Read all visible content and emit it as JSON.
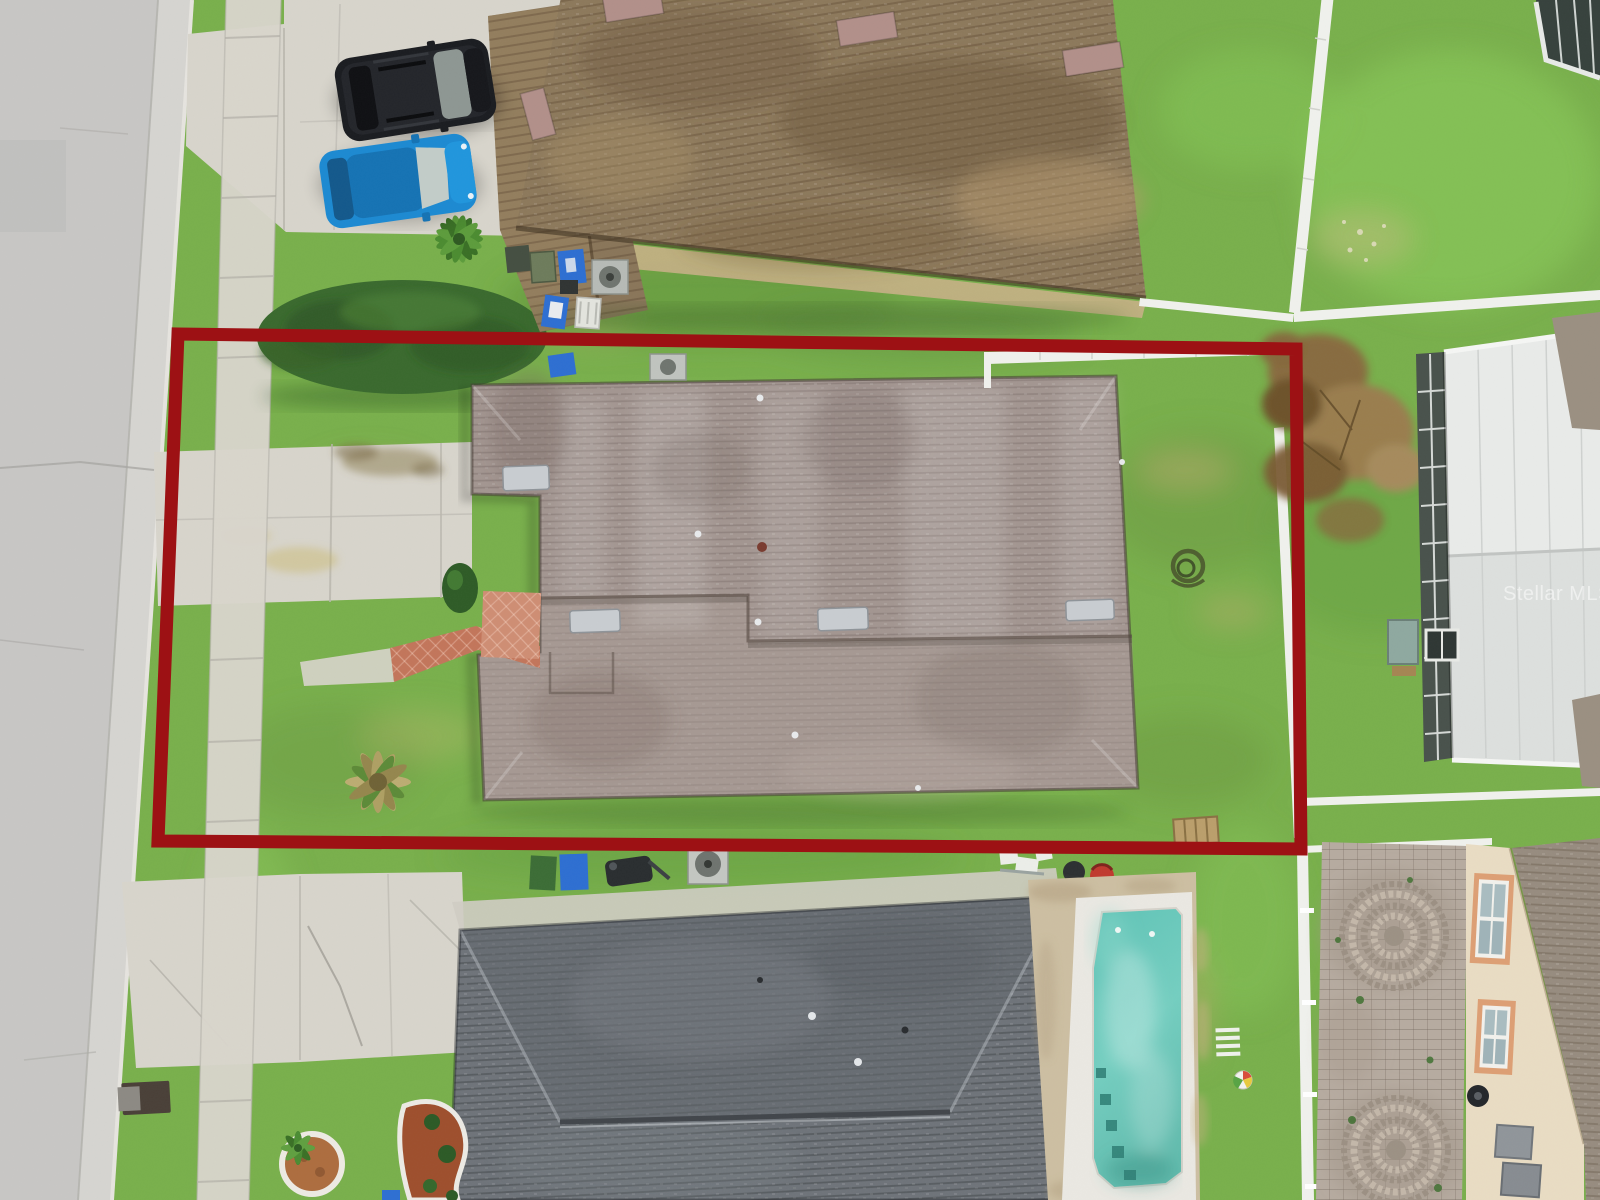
{
  "image": {
    "kind": "aerial-drone-photo",
    "subject": "residential lot with red property boundary overlay",
    "width_px": 1600,
    "height_px": 1200
  },
  "watermark": {
    "text": "Stellar MLS",
    "color": "#ffffff",
    "opacity": 0.52
  },
  "boundary": {
    "name": "property-boundary",
    "color": "#9d1114",
    "stroke_width": 13
  },
  "palette": {
    "grass": "#79b04c",
    "grassDark": "#5c8f3a",
    "grassLight": "#8ec561",
    "street": "#c8c7c5",
    "gutter": "#d6d5d1",
    "concrete": "#d8d5cc",
    "hedge": "#3a6a2e",
    "topRoof": "#8d795c",
    "subjectRoof": "#a39691",
    "bottomRoof": "#6f747a",
    "poolWater": "#68c8ba",
    "poolDeck": "#eae8e2",
    "paver": "#b6aba0",
    "poolPaver": "#cdbfa2",
    "fence": "#f0f1ed",
    "creamWall": "#e9dcc3",
    "suvBlack": "#1b1d21",
    "carBlue": "#1d8ad2",
    "brickWalk": "#c3765b",
    "mulchRed": "#9e4f2d"
  },
  "objects": [
    "street",
    "sidewalk",
    "driveways",
    "hedge",
    "black-suv",
    "blue-car",
    "top-neighbor-house",
    "subject-house",
    "trash-bins",
    "ac-units",
    "front-dead-palm",
    "backyard-hose-coil",
    "wood-pallet",
    "white-fences",
    "dead-tree",
    "screened-lanai",
    "bottom-house",
    "swimming-pool",
    "beach-ball",
    "paver-driveway",
    "bottom-right-house",
    "circular-planter",
    "mulch-bed",
    "storm-drain"
  ]
}
